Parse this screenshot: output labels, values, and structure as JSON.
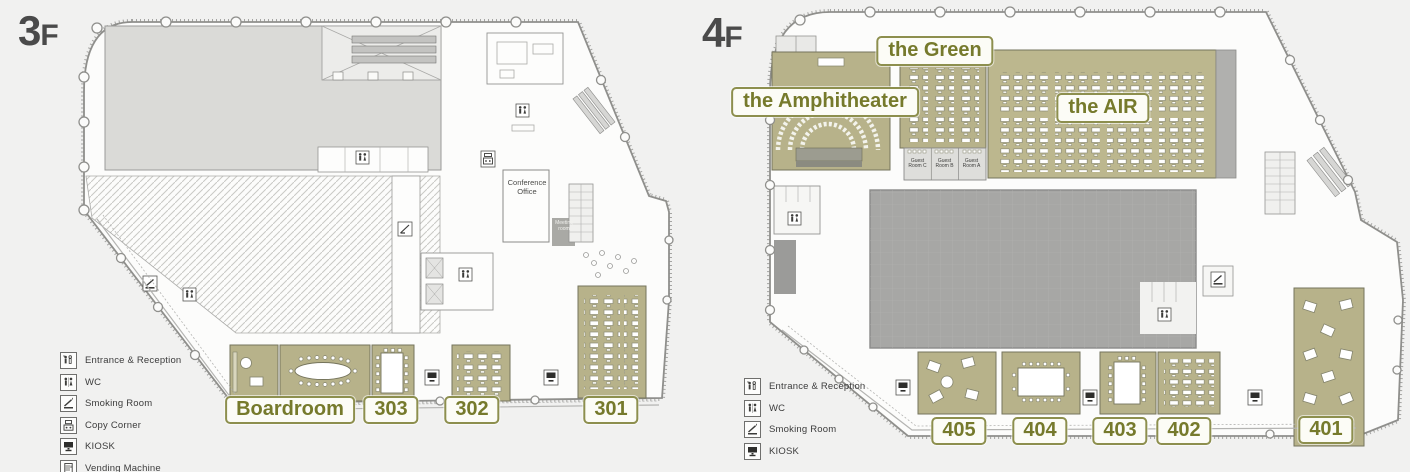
{
  "page": {
    "background": "#f1f1f0"
  },
  "colors": {
    "room_fill": "#b7b28a",
    "badge_border": "#8d8f4e",
    "badge_text": "#767a2c",
    "floor_label": "#4a4a4a"
  },
  "floors": [
    {
      "floor_label": "3F",
      "rooms": [
        {
          "name": "Boardroom"
        },
        {
          "name": "303"
        },
        {
          "name": "302"
        },
        {
          "name": "301"
        }
      ],
      "plan_texts": {
        "conference_office": "Conference Office",
        "meeting_room": "Meeting room"
      },
      "legend": [
        {
          "icon": "entrance-icon",
          "label": "Entrance & Reception"
        },
        {
          "icon": "wc-icon",
          "label": "WC"
        },
        {
          "icon": "smoking-icon",
          "label": "Smoking Room"
        },
        {
          "icon": "copy-icon",
          "label": "Copy Corner"
        },
        {
          "icon": "kiosk-icon",
          "label": "KIOSK"
        },
        {
          "icon": "vending-icon",
          "label": "Vending Machine"
        }
      ]
    },
    {
      "floor_label": "4F",
      "areas": [
        {
          "name": "the Green"
        },
        {
          "name": "the Amphitheater"
        },
        {
          "name": "the AIR"
        }
      ],
      "rooms": [
        {
          "name": "405"
        },
        {
          "name": "404"
        },
        {
          "name": "403"
        },
        {
          "name": "402"
        },
        {
          "name": "401"
        }
      ],
      "guest_rooms": [
        "Guest Room C",
        "Guest Room B",
        "Guest Room A"
      ],
      "legend": [
        {
          "icon": "entrance-icon",
          "label": "Entrance & Reception"
        },
        {
          "icon": "wc-icon",
          "label": "WC"
        },
        {
          "icon": "smoking-icon",
          "label": "Smoking Room"
        },
        {
          "icon": "kiosk-icon",
          "label": "KIOSK"
        }
      ]
    }
  ]
}
